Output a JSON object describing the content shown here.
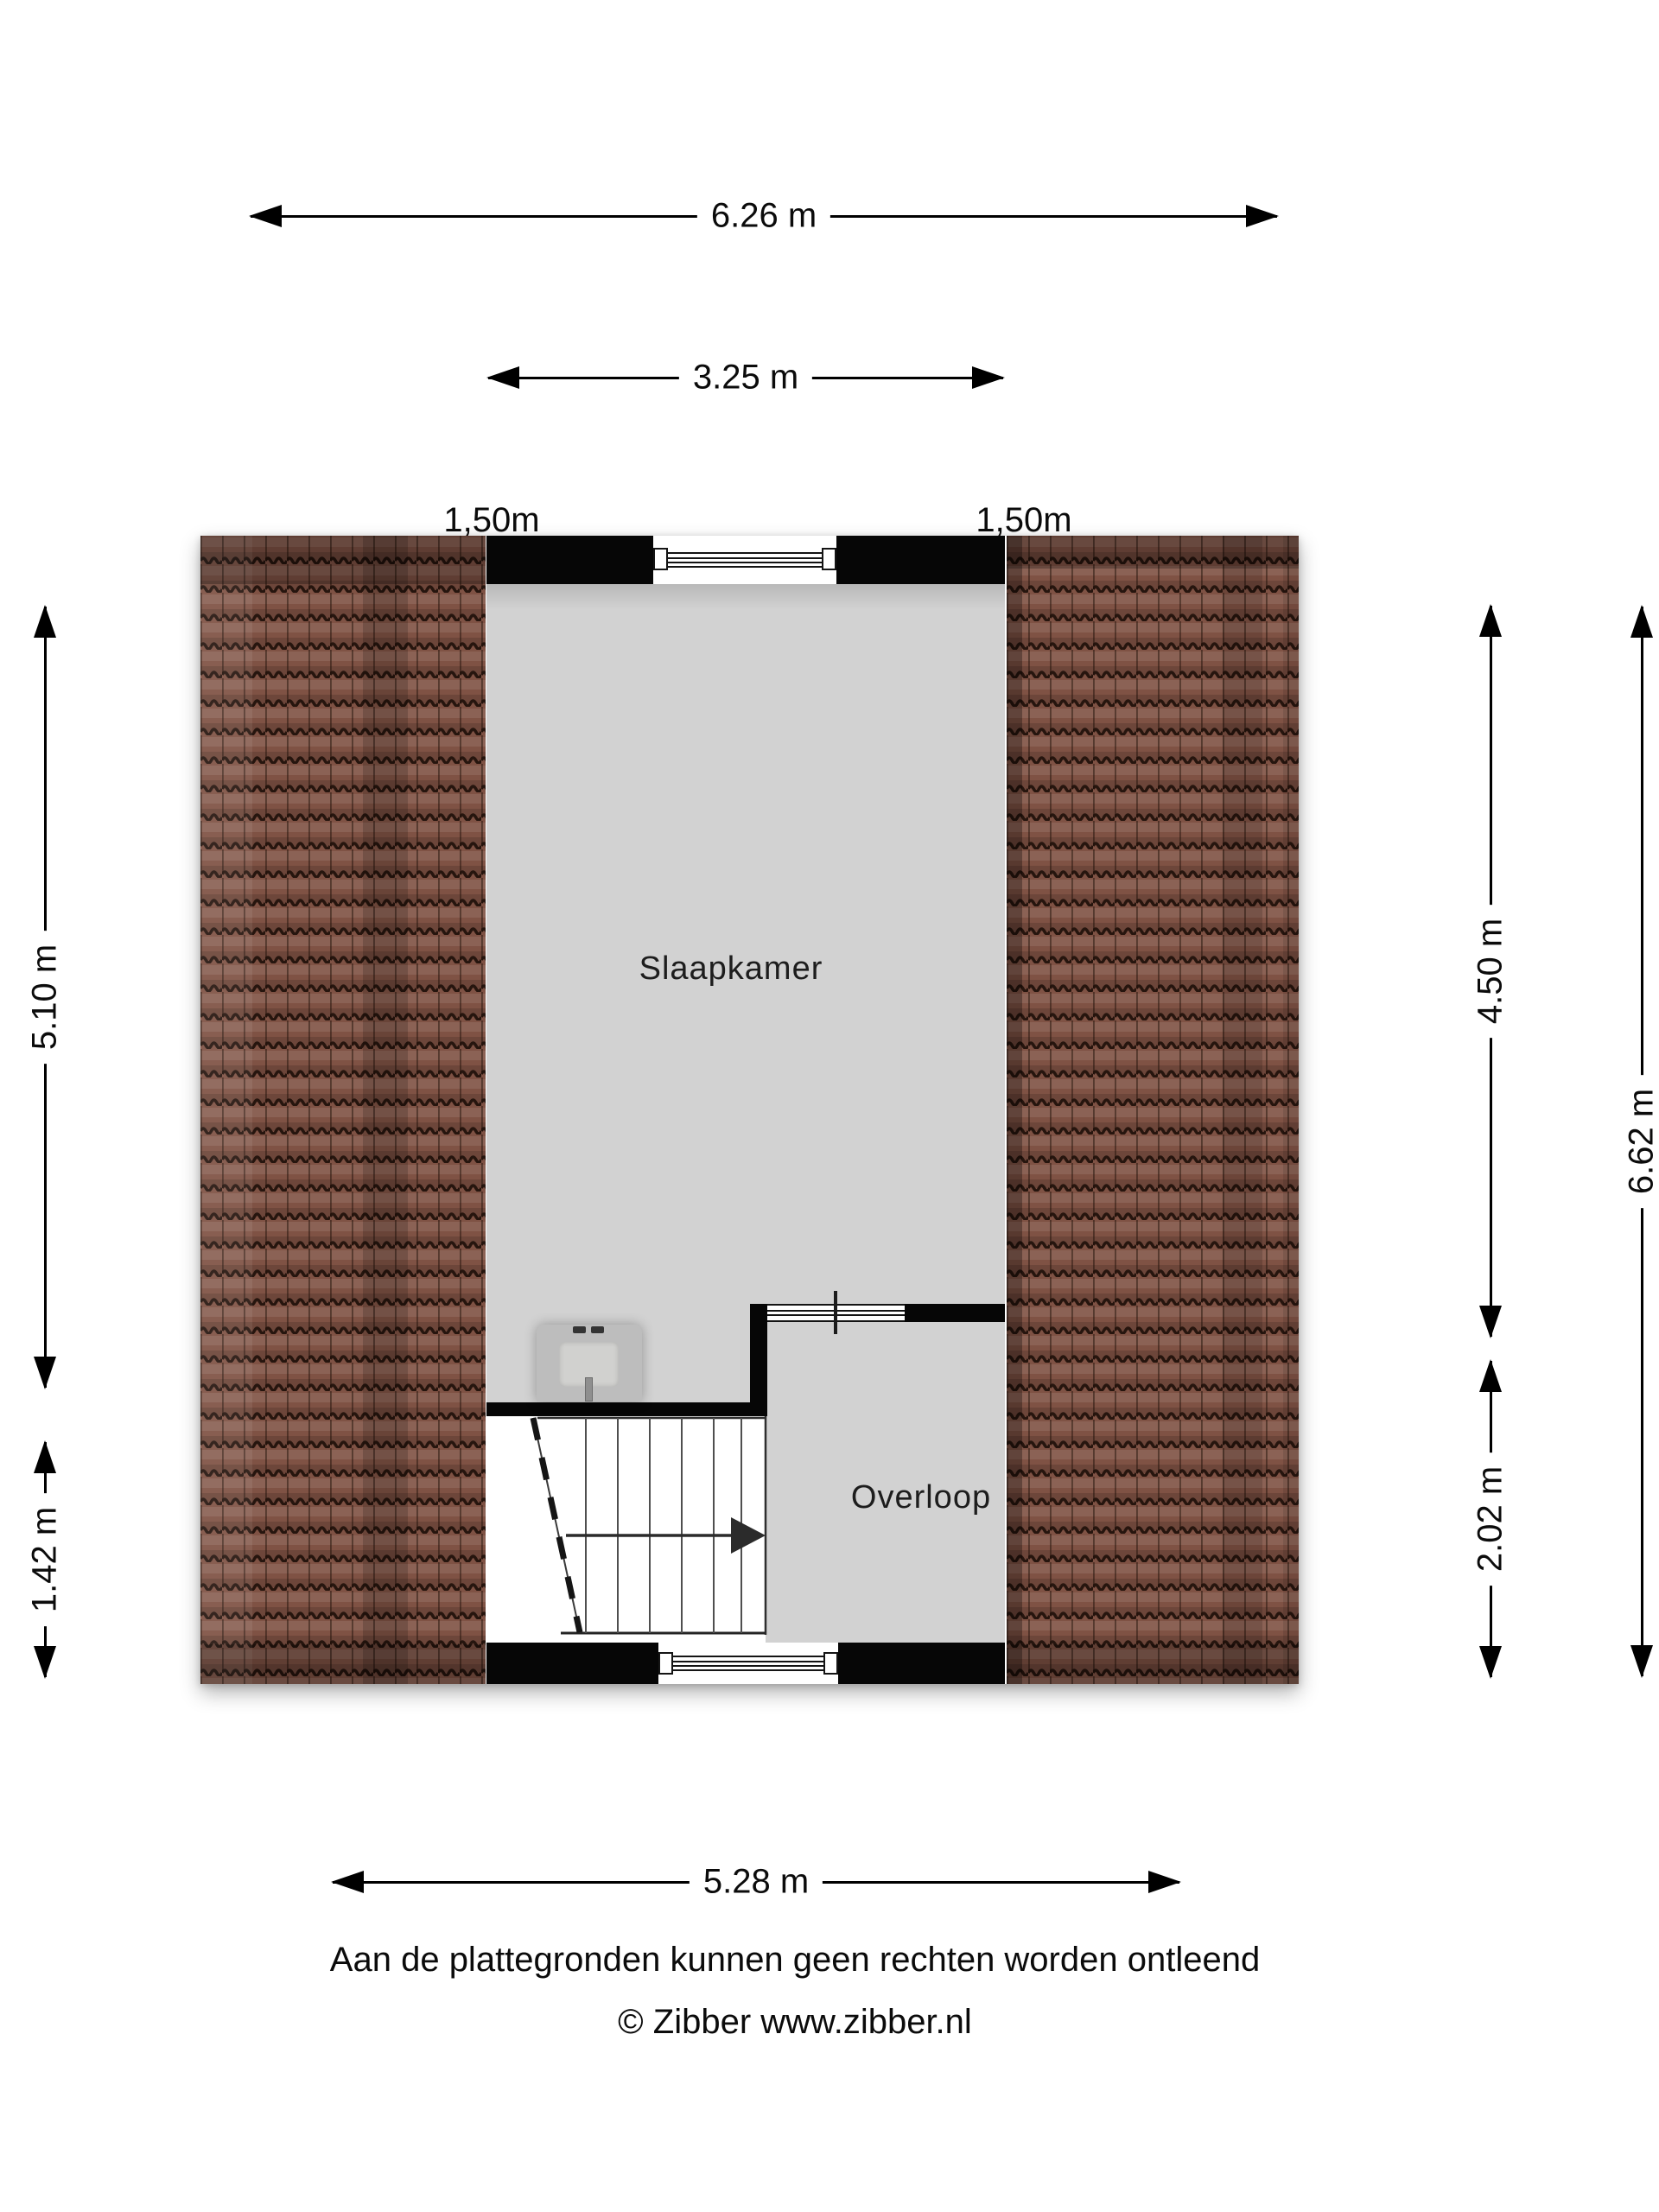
{
  "dims": {
    "top_outer": "6.26 m",
    "top_inner": "3.25 m",
    "left_dormer": "1,50m",
    "right_dormer": "1,50m",
    "left_upper": "5.10 m",
    "left_lower": "1.42 m",
    "right_upper": "4.50 m",
    "right_lower": "2.02 m",
    "right_outer": "6.62 m",
    "bottom": "5.28 m"
  },
  "rooms": {
    "bedroom": "Slaapkamer",
    "landing": "Overloop"
  },
  "footer": {
    "disclaimer": "Aan de plattegronden kunnen geen rechten worden ontleend",
    "copyright": "© Zibber www.zibber.nl"
  },
  "colors": {
    "wall": "#060606",
    "floor": "#d2d2d2",
    "roof_tile": "#7f5244",
    "stairs": "#ffffff"
  }
}
